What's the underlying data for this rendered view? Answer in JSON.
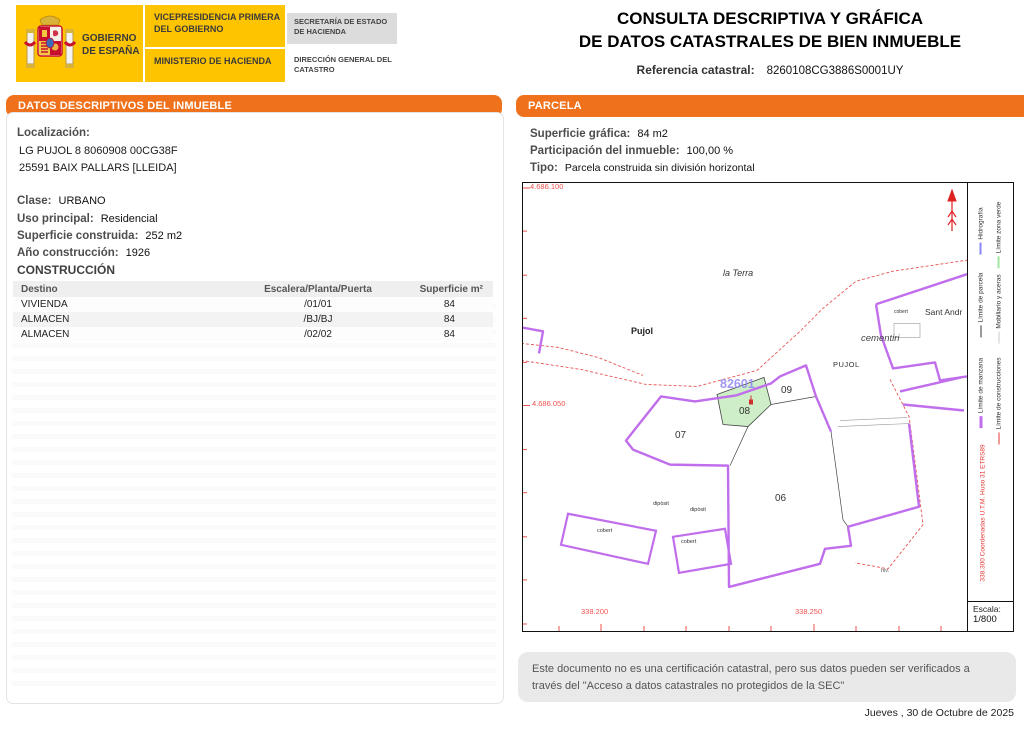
{
  "header": {
    "gobierno": "GOBIERNO DE ESPAÑA",
    "vicepresidencia": "VICEPRESIDENCIA PRIMERA DEL GOBIERNO",
    "ministerio": "MINISTERIO DE HACIENDA",
    "secretaria": "SECRETARÍA DE ESTADO DE HACIENDA",
    "direccion_general": "DIRECCIÓN GENERAL DEL CATASTRO",
    "title_line1": "CONSULTA DESCRIPTIVA Y GRÁFICA",
    "title_line2": "DE DATOS CATASTRALES DE BIEN INMUEBLE",
    "ref_label": "Referencia catastral:",
    "ref_value": "8260108CG3886S0001UY"
  },
  "left_panel": {
    "header": "DATOS DESCRIPTIVOS DEL INMUEBLE",
    "localizacion_label": "Localización:",
    "localizacion_line1": "LG PUJOL 8 8060908 00CG38F",
    "localizacion_line2": "25591 BAIX PALLARS [LLEIDA]",
    "fields": [
      {
        "label": "Clase:",
        "value": "URBANO"
      },
      {
        "label": "Uso principal:",
        "value": "Residencial"
      },
      {
        "label": "Superficie construida:",
        "value": "252 m2"
      },
      {
        "label": "Año construcción:",
        "value": "1926"
      }
    ],
    "construccion": {
      "title": "CONSTRUCCIÓN",
      "columns": [
        "Destino",
        "Escalera/Planta/Puerta",
        "Superficie m²"
      ],
      "rows": [
        [
          "VIVIENDA",
          "/01/01",
          "84"
        ],
        [
          "ALMACEN",
          "/BJ/BJ",
          "84"
        ],
        [
          "ALMACEN",
          "/02/02",
          "84"
        ]
      ]
    }
  },
  "parcela_panel": {
    "header": "PARCELA",
    "fields": [
      {
        "label": "Superficie gráfica:",
        "value": "84 m2"
      },
      {
        "label": "Participación del inmueble:",
        "value": "100,00 %"
      },
      {
        "label": "Tipo:",
        "value": "Parcela construida sin división horizontal"
      }
    ],
    "map": {
      "coords": {
        "top": "4.686.100",
        "left": "4.686.050",
        "bottom1": "338.200",
        "bottom2": "338.250"
      },
      "labels": {
        "la_terra": "la Terra",
        "pujol_small": "Pujol",
        "pujol_caps": "PUJOL",
        "cementiri": "cementiri",
        "sant_andr": "Sant Andr",
        "cobert_cementiri": "cobert",
        "manzana_ref": "82601",
        "p08": "08",
        "p09": "09",
        "p07": "07",
        "p06": "06",
        "diposit1": "dipòsit",
        "diposit2": "dipòsit",
        "cobert1": "cobert",
        "cobert2": "cobert",
        "hiv": "hiv."
      },
      "legend": {
        "items": [
          {
            "label": "Hidrografía",
            "color": "#8a8af5"
          },
          {
            "label": "Límite zona verde",
            "color": "#9fe69f"
          },
          {
            "label": "Límite de parcela",
            "color": "#333333"
          },
          {
            "label": "Mobiliario y aceras",
            "color": "#c9c9c9"
          },
          {
            "label": "Límite de manzana",
            "color": "#c06eec"
          },
          {
            "label": "Límite de construcciones",
            "color": "#e53935"
          }
        ],
        "coords_note": "338.300 Coordenadas U.T.M. Huso 31 ETRS89",
        "escala_label": "Escala:",
        "escala_value": "1/800"
      }
    }
  },
  "footer": {
    "disclaimer": "Este documento no es una certificación catastral, pero sus datos pueden ser verificados a través del \"Acceso a datos catastrales no protegidos de la SEC\"",
    "date": "Jueves , 30 de Octubre de 2025"
  },
  "colors": {
    "accent_orange": "#F0711C",
    "brand_yellow": "#FFC400",
    "map_purple": "#C06EEC",
    "parcel_green_fill": "#CDEEC6",
    "map_red": "#E53935"
  }
}
